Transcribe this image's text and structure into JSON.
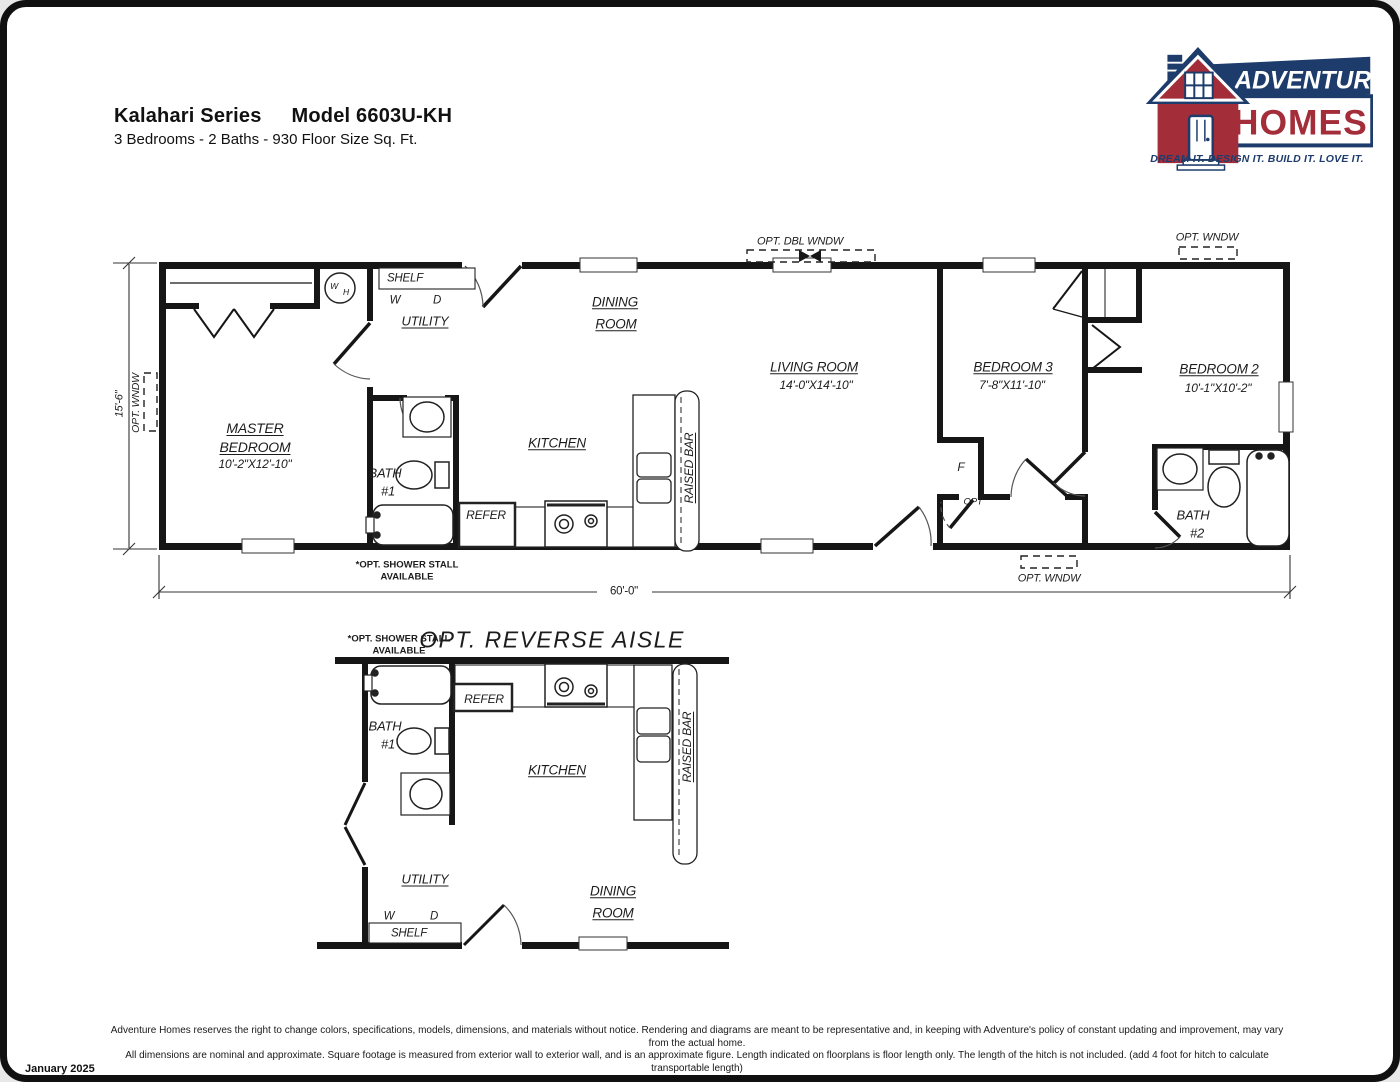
{
  "header": {
    "series": "Kalahari Series",
    "model": "Model 6603U-KH",
    "subtitle": "3 Bedrooms - 2 Baths - 930 Floor Size Sq. Ft."
  },
  "logo": {
    "brand_top": "ADVENTURE",
    "brand_bottom": "HOMES",
    "tagline": "DREAM IT.  DESIGN IT.  BUILD IT.  LOVE IT.",
    "colors": {
      "navy": "#1d3c6b",
      "red": "#a32d39"
    }
  },
  "plan1": {
    "master_1": "MASTER",
    "master_2": "BEDROOM",
    "master_dims": "10'-2\"X12'-10\"",
    "utility": "UTILITY",
    "dining_1": "DINING",
    "dining_2": "ROOM",
    "kitchen": "KITCHEN",
    "living": "LIVING ROOM",
    "living_dims": "14'-0\"X14'-10\"",
    "bedroom3": "BEDROOM 3",
    "bedroom3_dims": "7'-8\"X11'-10\"",
    "bedroom2": "BEDROOM 2",
    "bedroom2_dims": "10'-1\"X10'-2\"",
    "bath1_1": "BATH",
    "bath1_2": "#1",
    "bath2_1": "BATH",
    "bath2_2": "#2",
    "shelf": "SHELF",
    "w": "W",
    "d": "D",
    "wh_w": "W",
    "wh_h": "H",
    "refer": "REFER",
    "raised_bar": "RAISED BAR",
    "f": "F",
    "opt": "OPT",
    "opt_dbl_wndw": "OPT. DBL WNDW",
    "opt_wndw": "OPT. WNDW",
    "shower_1": "*OPT. SHOWER STALL",
    "shower_2": "AVAILABLE",
    "dim_width": "60'-0\"",
    "dim_height": "15'-6\""
  },
  "plan2": {
    "title": "OPT. REVERSE AISLE",
    "shower_1": "*OPT. SHOWER STALL",
    "shower_2": "AVAILABLE",
    "bath1_1": "BATH",
    "bath1_2": "#1",
    "refer": "REFER",
    "kitchen": "KITCHEN",
    "raised_bar": "RAISED BAR",
    "utility": "UTILITY",
    "w": "W",
    "d": "D",
    "shelf": "SHELF",
    "dining_1": "DINING",
    "dining_2": "ROOM"
  },
  "footer": {
    "line1": "Adventure Homes reserves the right to change colors, specifications, models, dimensions, and materials without notice. Rendering and diagrams are meant to be representative and, in keeping with Adventure's policy of constant updating and improvement, may vary from the actual home.",
    "line2": "All dimensions are nominal and approximate. Square footage is measured from exterior wall to exterior wall, and is an approximate figure. Length indicated on floorplans is floor length only. The length of the hitch is not included. (add 4 foot for hitch to calculate transportable length)",
    "line3": "Ask your retailer for specifics. PRICE AND SPECIFICATIONS SUBJECT TO CHANGE WITHOUT NOTICE OR OBLIGATION.",
    "date": "January 2025"
  }
}
